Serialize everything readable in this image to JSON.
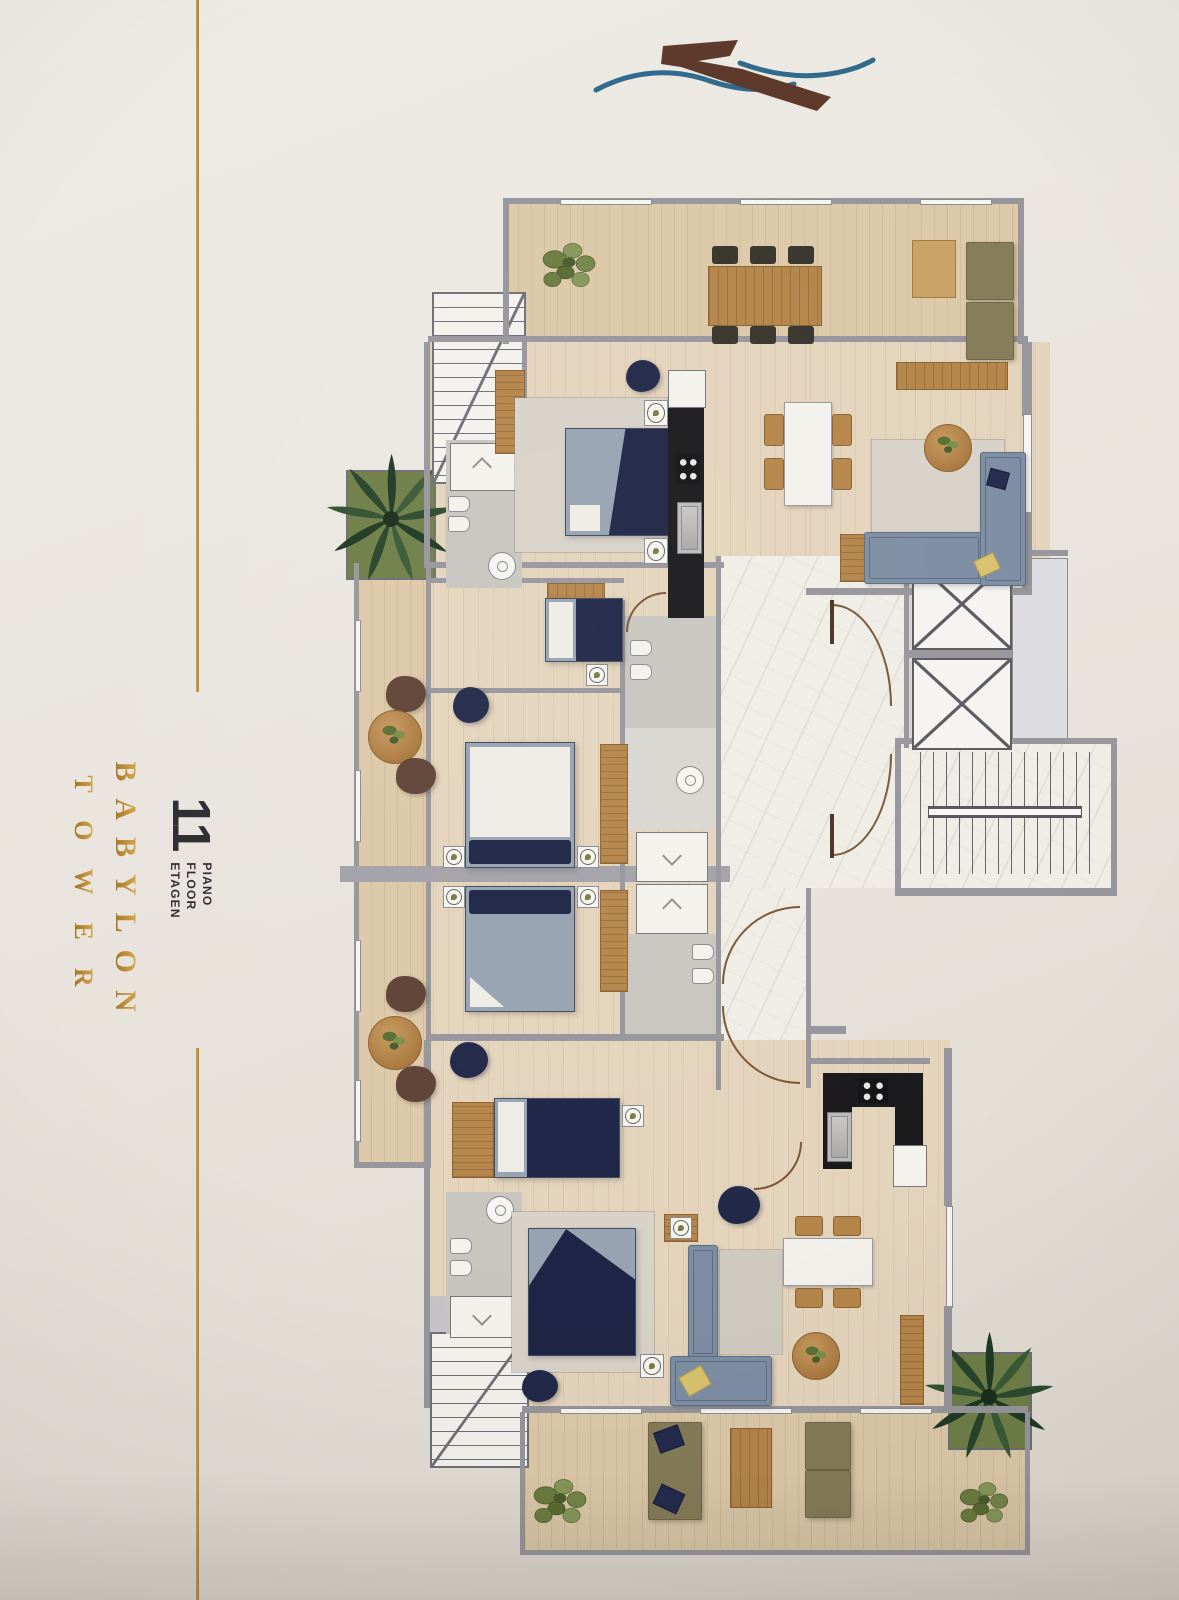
{
  "branding": {
    "tower_name": [
      "BABYLON",
      "TOWER"
    ],
    "floor_number": "11",
    "floor_words": [
      "PIANO",
      "FLOOR",
      "ETAGEN"
    ],
    "gold_color": "#b8892f",
    "number_color": "#2d2c30"
  },
  "logo": {
    "mark_color": "#5c392b",
    "wave_color": "#2f6a8c"
  },
  "floor_plan": {
    "palette": {
      "walls": "#97969c",
      "wood_floor": "#e4d4bc",
      "terrace_floor": "#dcc9a9",
      "marble_floor": "#efede6",
      "kitchen_black": "#1a191b",
      "bed_navy": "#1f2546",
      "mattress_gray": "#97a3b1",
      "sofa_blue": "#7d8da3",
      "outdoor_olive": "#867c59",
      "armchair_brown": "#5f4336",
      "furniture_wood": "#b5854a",
      "plant_green": "#5a6c34",
      "rug_gray": "#d8d2c9",
      "bathroom_gray": "#c9c5bf"
    },
    "features": {
      "elevators": 2,
      "stairwells": 3,
      "double_beds": 4,
      "single_beds": 2,
      "terraces": 2,
      "palm_planters": 2
    }
  }
}
